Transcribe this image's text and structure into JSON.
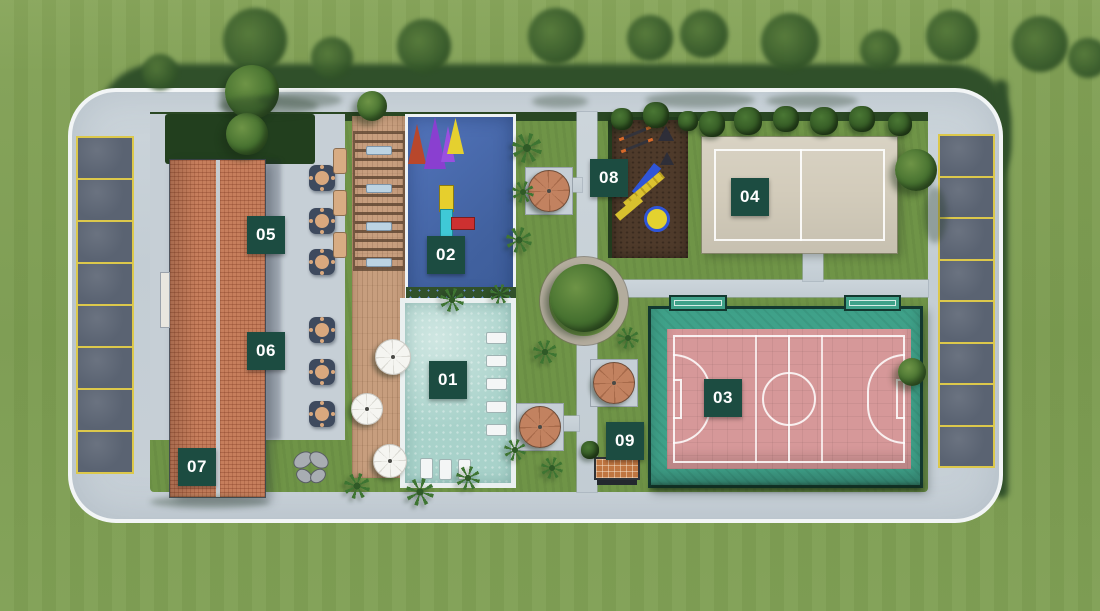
{
  "colors": {
    "badge_bg": "#1c4c41",
    "badge_fg": "#ffffff",
    "parking_line": "#dcc84b",
    "road": "#c7d0d7",
    "grass": "#7d9d52",
    "roof": "#c67e5c",
    "pool_kids": "#4a6bb1",
    "pool_main": "#a8d2ca",
    "court_sand": "#d3ccbb",
    "court_field": "#d69899",
    "court_surround": "#3fa189"
  },
  "badges": [
    {
      "label": "01",
      "x": 429,
      "y": 361
    },
    {
      "label": "02",
      "x": 427,
      "y": 236
    },
    {
      "label": "03",
      "x": 704,
      "y": 379
    },
    {
      "label": "04",
      "x": 731,
      "y": 178
    },
    {
      "label": "05",
      "x": 247,
      "y": 216
    },
    {
      "label": "06",
      "x": 247,
      "y": 332
    },
    {
      "label": "07",
      "x": 178,
      "y": 448
    },
    {
      "label": "08",
      "x": 590,
      "y": 159
    },
    {
      "label": "09",
      "x": 606,
      "y": 422
    }
  ],
  "parking": {
    "left": {
      "x": 76,
      "y": 136,
      "w": 58,
      "h": 338,
      "spots": 8
    },
    "right": {
      "x": 938,
      "y": 134,
      "w": 57,
      "h": 334,
      "spots": 8
    }
  },
  "furniture": {
    "gazebos": [
      {
        "x": 549,
        "y": 191
      },
      {
        "x": 614,
        "y": 383
      },
      {
        "x": 540,
        "y": 427
      }
    ],
    "umbrellas": [
      {
        "x": 393,
        "y": 357,
        "s": 36
      },
      {
        "x": 367,
        "y": 409,
        "s": 32
      },
      {
        "x": 390,
        "y": 461,
        "s": 34
      }
    ],
    "patio_tables": {
      "x": 322,
      "ys": [
        178,
        221,
        262,
        330,
        372,
        414
      ]
    },
    "patio_loungers": [
      {
        "x": 333,
        "y": 148
      },
      {
        "x": 333,
        "y": 190
      },
      {
        "x": 333,
        "y": 232
      }
    ],
    "pergola_loungers": [
      {
        "x": 366,
        "y": 146
      },
      {
        "x": 366,
        "y": 184
      },
      {
        "x": 366,
        "y": 222
      },
      {
        "x": 366,
        "y": 258
      }
    ],
    "pool_loungers_right": [
      [
        486,
        332
      ],
      [
        486,
        355
      ],
      [
        486,
        378
      ],
      [
        486,
        401
      ],
      [
        486,
        424
      ]
    ],
    "pool_loungers_bottom": [
      [
        420,
        458
      ],
      [
        439,
        459
      ],
      [
        458,
        459
      ]
    ],
    "sails": [
      {
        "x": 408,
        "y": 124,
        "w": 18,
        "h": 40,
        "c": "#b8472c"
      },
      {
        "x": 424,
        "y": 117,
        "w": 22,
        "h": 52,
        "c": "#8a3fd0"
      },
      {
        "x": 441,
        "y": 126,
        "w": 14,
        "h": 36,
        "c": "#9a4fe0"
      },
      {
        "x": 447,
        "y": 118,
        "w": 17,
        "h": 36,
        "c": "#e5d02f"
      }
    ]
  },
  "vegetation": [
    {
      "t": "top",
      "x": 255,
      "y": 40,
      "s": 64
    },
    {
      "t": "top",
      "x": 332,
      "y": 58,
      "s": 42
    },
    {
      "t": "top",
      "x": 424,
      "y": 46,
      "s": 54
    },
    {
      "t": "top",
      "x": 556,
      "y": 36,
      "s": 56
    },
    {
      "t": "top",
      "x": 650,
      "y": 38,
      "s": 46
    },
    {
      "t": "top",
      "x": 704,
      "y": 34,
      "s": 48
    },
    {
      "t": "top",
      "x": 790,
      "y": 42,
      "s": 58
    },
    {
      "t": "top",
      "x": 880,
      "y": 50,
      "s": 40
    },
    {
      "t": "top",
      "x": 952,
      "y": 36,
      "s": 52
    },
    {
      "t": "top",
      "x": 1040,
      "y": 44,
      "s": 56
    },
    {
      "t": "top",
      "x": 1088,
      "y": 58,
      "s": 40
    },
    {
      "t": "top",
      "x": 160,
      "y": 72,
      "s": 36
    },
    {
      "t": "tree",
      "x": 252,
      "y": 92,
      "s": 54
    },
    {
      "t": "tree",
      "x": 247,
      "y": 134,
      "s": 42
    },
    {
      "t": "tree",
      "x": 372,
      "y": 106,
      "s": 30
    },
    {
      "t": "tree",
      "x": 584,
      "y": 298,
      "s": 68
    },
    {
      "t": "tree",
      "x": 916,
      "y": 170,
      "s": 42
    },
    {
      "t": "tree",
      "x": 912,
      "y": 372,
      "s": 28
    },
    {
      "t": "bush",
      "x": 712,
      "y": 124,
      "s": 26
    },
    {
      "t": "bush",
      "x": 748,
      "y": 121,
      "s": 28
    },
    {
      "t": "bush",
      "x": 786,
      "y": 119,
      "s": 26
    },
    {
      "t": "bush",
      "x": 824,
      "y": 121,
      "s": 28
    },
    {
      "t": "bush",
      "x": 862,
      "y": 119,
      "s": 26
    },
    {
      "t": "bush",
      "x": 900,
      "y": 124,
      "s": 24
    },
    {
      "t": "bush",
      "x": 622,
      "y": 119,
      "s": 22
    },
    {
      "t": "bush",
      "x": 656,
      "y": 115,
      "s": 26
    },
    {
      "t": "bush",
      "x": 688,
      "y": 121,
      "s": 20
    },
    {
      "t": "bush",
      "x": 590,
      "y": 450,
      "s": 18
    },
    {
      "t": "palm",
      "x": 527,
      "y": 148,
      "s": 30
    },
    {
      "t": "palm",
      "x": 519,
      "y": 240,
      "s": 26
    },
    {
      "t": "palm",
      "x": 523,
      "y": 192,
      "s": 22
    },
    {
      "t": "palm",
      "x": 545,
      "y": 352,
      "s": 24
    },
    {
      "t": "palm",
      "x": 452,
      "y": 300,
      "s": 24
    },
    {
      "t": "palm",
      "x": 500,
      "y": 294,
      "s": 20
    },
    {
      "t": "palm",
      "x": 357,
      "y": 486,
      "s": 26
    },
    {
      "t": "palm",
      "x": 420,
      "y": 492,
      "s": 28
    },
    {
      "t": "palm",
      "x": 468,
      "y": 478,
      "s": 24
    },
    {
      "t": "palm",
      "x": 515,
      "y": 450,
      "s": 22
    },
    {
      "t": "palm",
      "x": 552,
      "y": 468,
      "s": 22
    },
    {
      "t": "palm",
      "x": 628,
      "y": 338,
      "s": 22
    },
    {
      "t": "sh",
      "x": 300,
      "y": 100,
      "w": 84,
      "h": 16
    },
    {
      "t": "sh",
      "x": 560,
      "y": 101,
      "w": 56,
      "h": 13
    },
    {
      "t": "sh",
      "x": 700,
      "y": 100,
      "w": 110,
      "h": 16
    },
    {
      "t": "sh",
      "x": 812,
      "y": 101,
      "w": 92,
      "h": 14
    },
    {
      "t": "sh",
      "x": 268,
      "y": 106,
      "w": 100,
      "h": 20
    },
    {
      "t": "sh",
      "x": 935,
      "y": 215,
      "w": 24,
      "h": 56
    },
    {
      "t": "sh",
      "x": 210,
      "y": 502,
      "w": 120,
      "h": 12
    }
  ]
}
